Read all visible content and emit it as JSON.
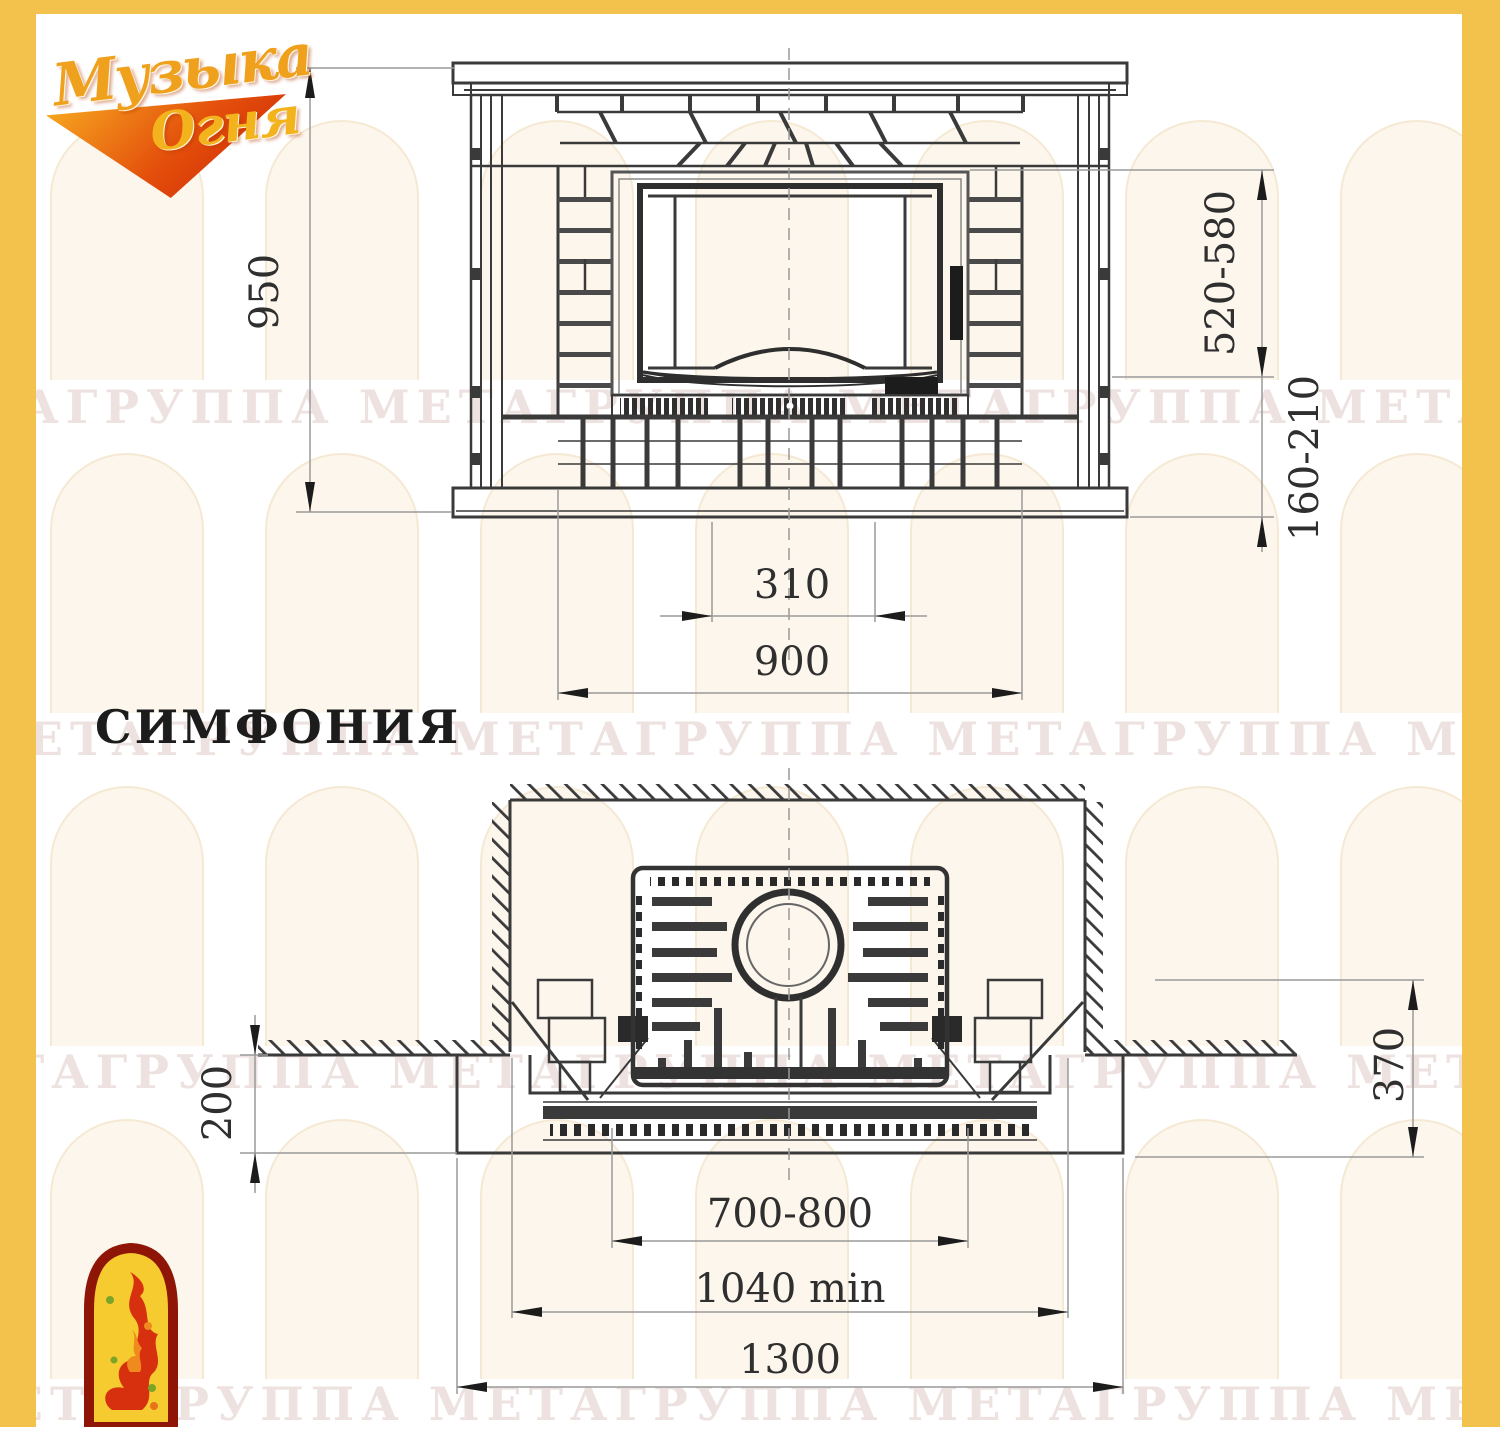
{
  "logo": {
    "line1": "Музыка",
    "line2": "Огня"
  },
  "title": "СИМФОНИЯ",
  "watermark": {
    "text": "МЕТАГРУППА МЕТАГРУППА МЕТАГРУППА МЕТАГРУППА МЕТА"
  },
  "front_view": {
    "dims": {
      "overall_height": "950",
      "opening_height": "520-580",
      "hearth_height": "160-210",
      "ash_vent_width": "310",
      "base_width": "900"
    }
  },
  "plan_view": {
    "dims": {
      "hearth_front_depth": "200",
      "side_depth": "370",
      "portal_opening_width": "700-800",
      "niche_width_min": "1040 min",
      "hearth_width": "1300"
    }
  }
}
